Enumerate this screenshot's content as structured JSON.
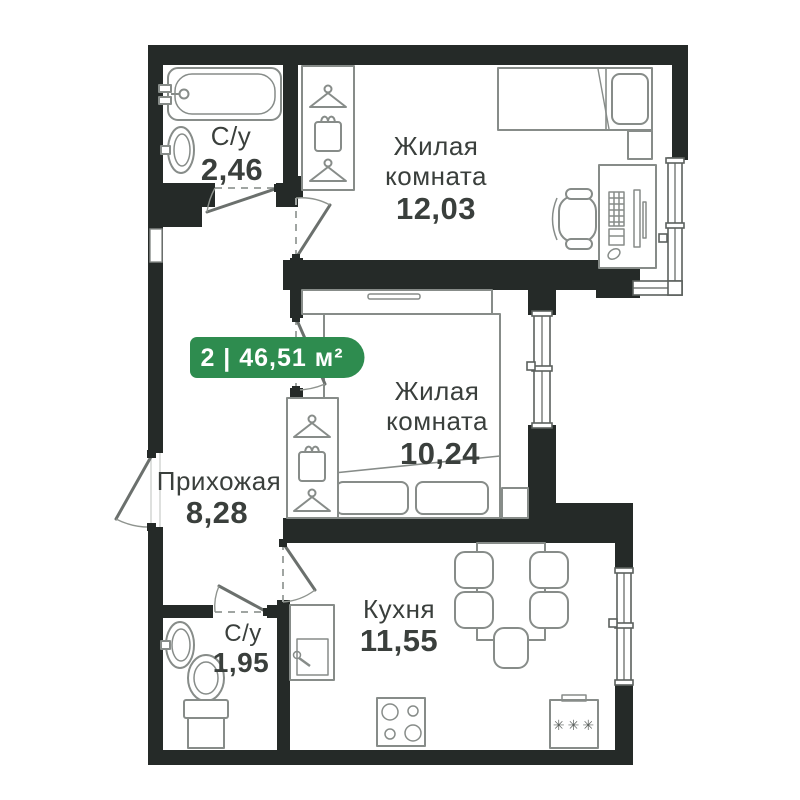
{
  "badge": {
    "label": "2 | 46,51 м²",
    "bg": "#2e8c4f",
    "text_color": "#ffffff"
  },
  "rooms": {
    "bath_top": {
      "name": "С/у",
      "area": "2,46"
    },
    "living_top": {
      "name_line1": "Жилая",
      "name_line2": "комната",
      "area": "12,03"
    },
    "living_mid": {
      "name_line1": "Жилая",
      "name_line2": "комната",
      "area": "10,24"
    },
    "hallway": {
      "name": "Прихожая",
      "area": "8,28"
    },
    "bath_bottom": {
      "name": "С/у",
      "area": "1,95"
    },
    "kitchen": {
      "name": "Кухня",
      "area": "11,55"
    }
  },
  "icons": {
    "fridge_marks": "✳✳✳"
  },
  "colors": {
    "wall": "#252a28",
    "furniture_stroke": "#878c89",
    "text": "#3a3f3c",
    "badge_green": "#2e8c4f",
    "background": "#ffffff"
  }
}
